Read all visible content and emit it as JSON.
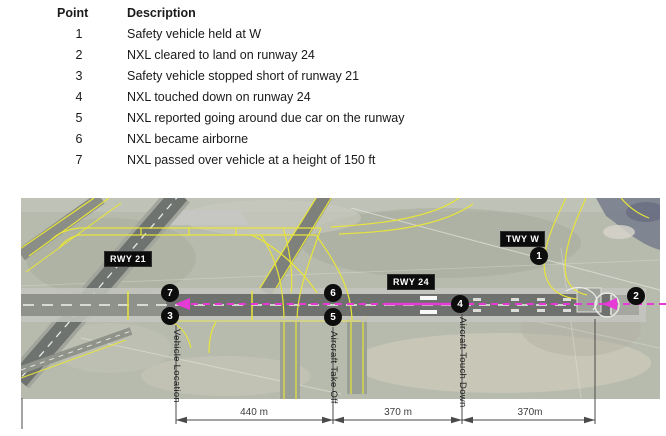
{
  "table": {
    "point_header": "Point",
    "description_header": "Description",
    "rows": [
      {
        "point": "1",
        "description": "Safety vehicle held at W"
      },
      {
        "point": "2",
        "description": "NXL cleared to land on runway 24"
      },
      {
        "point": "3",
        "description": "Safety vehicle stopped short of runway 21"
      },
      {
        "point": "4",
        "description": "NXL touched down on runway 24"
      },
      {
        "point": "5",
        "description": "NXL reported going around due car on the runway"
      },
      {
        "point": "6",
        "description": "NXL became airborne"
      },
      {
        "point": "7",
        "description": "NXL passed over vehicle at a height of 150 ft"
      }
    ]
  },
  "map": {
    "runway_labels": {
      "rwy21": "RWY 21",
      "rwy24": "RWY 24",
      "twy_w": "TWY W"
    },
    "point_markers": [
      "1",
      "2",
      "3",
      "4",
      "5",
      "6",
      "7"
    ],
    "annotations": {
      "vehicle_location": "Vehicle Location",
      "aircraft_take_off": "Aircraft Take Off",
      "aircraft_touch_down": "Aircraft Touch Down"
    },
    "dimensions": [
      "440 m",
      "370 m",
      "370m"
    ],
    "colors": {
      "flight_path": "#e63ad6",
      "taxiway_line": "#e8e53a",
      "runway_surface": "#6e716e",
      "marker": "#0d0d0d"
    }
  }
}
